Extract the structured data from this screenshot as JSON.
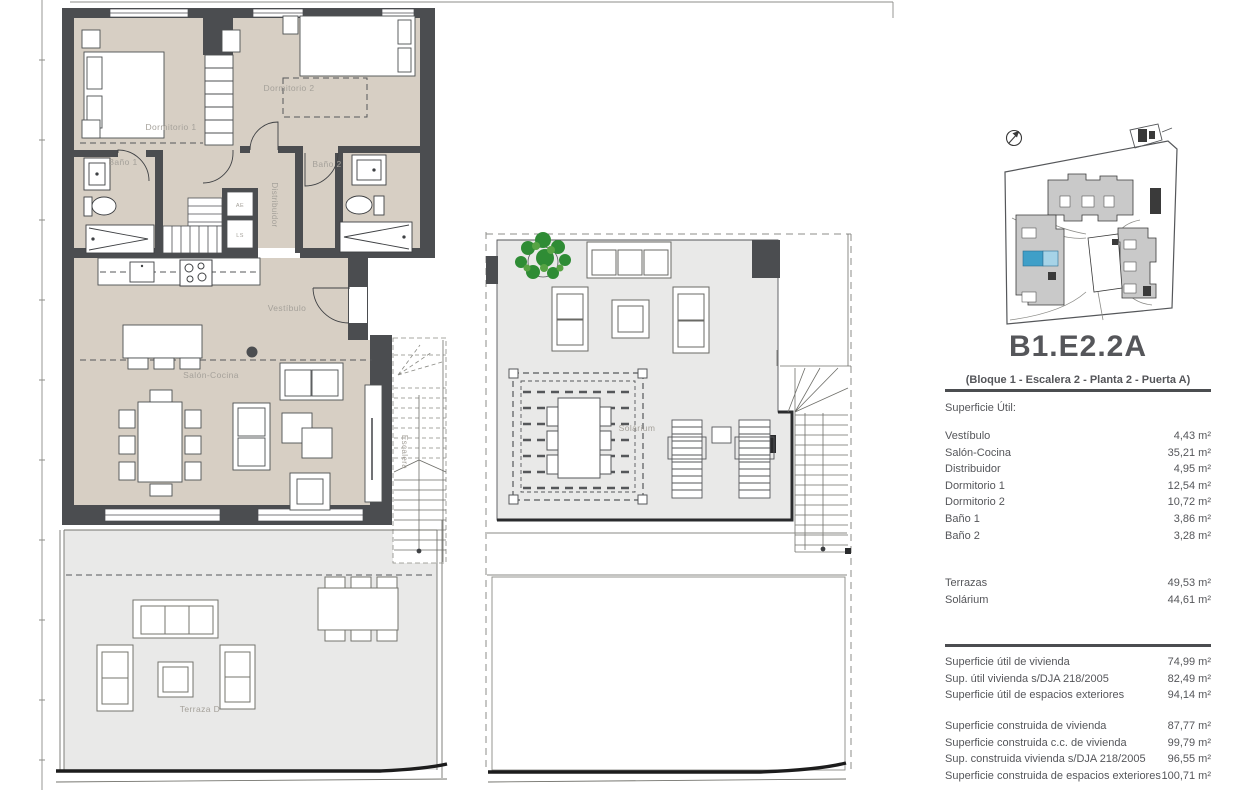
{
  "colors": {
    "wall": "#4b4d50",
    "interior_floor": "#d7cfc4",
    "terrace_floor": "#e9e9e8",
    "plan_label": "#a5a19a",
    "panel_text": "#55565a",
    "highlight_blue": "#3f9fc8",
    "highlight_blue_light": "#a6d3e7",
    "site_building": "#c9c9c9",
    "plant_green": "#2f8c35"
  },
  "plan1": {
    "labels": {
      "dormitorio1": "Dormitorio 1",
      "dormitorio2": "Dormitorio 2",
      "bano1": "Baño 1",
      "bano2": "Baño 2",
      "distribuidor": "Distribuidor",
      "vestibulo": "Vestíbulo",
      "salon_cocina": "Salón-Cocina",
      "escalera": "Escalera",
      "terraza": "Terraza D",
      "ae": "AE",
      "ls": "LS"
    }
  },
  "plan2": {
    "labels": {
      "solarium": "Solárium"
    }
  },
  "panel": {
    "unit_code": "B1.E2.2A",
    "unit_subtitle": "(Bloque 1 - Escalera 2 - Planta 2 - Puerta A)",
    "superficie_util_heading": "Superficie Útil:",
    "rooms": [
      {
        "label": "Vestíbulo",
        "value": "4,43 m²"
      },
      {
        "label": "Salón-Cocina",
        "value": "35,21 m²"
      },
      {
        "label": "Distribuidor",
        "value": "4,95 m²"
      },
      {
        "label": "Dormitorio 1",
        "value": "12,54 m²"
      },
      {
        "label": "Dormitorio 2",
        "value": "10,72 m²"
      },
      {
        "label": "Baño 1",
        "value": "3,86 m²"
      },
      {
        "label": "Baño 2",
        "value": "3,28 m²"
      }
    ],
    "exterior": [
      {
        "label": "Terrazas",
        "value": "49,53 m²"
      },
      {
        "label": "Solárium",
        "value": "44,61 m²"
      }
    ],
    "totals_util": [
      {
        "label": "Superficie útil de vivienda",
        "value": "74,99 m²"
      },
      {
        "label": "Sup. útil vivienda s/DJA 218/2005",
        "value": "82,49 m²"
      },
      {
        "label": "Superficie útil de espacios exteriores",
        "value": "94,14 m²"
      }
    ],
    "totals_construida": [
      {
        "label": "Superficie construida de vivienda",
        "value": "87,77 m²"
      },
      {
        "label": "Superficie construida c.c. de vivienda",
        "value": "99,79 m²"
      },
      {
        "label": "Sup. construida vivienda s/DJA 218/2005",
        "value": "96,55 m²"
      },
      {
        "label": "Superficie construida de espacios exteriores",
        "value": "100,71 m²"
      }
    ]
  }
}
